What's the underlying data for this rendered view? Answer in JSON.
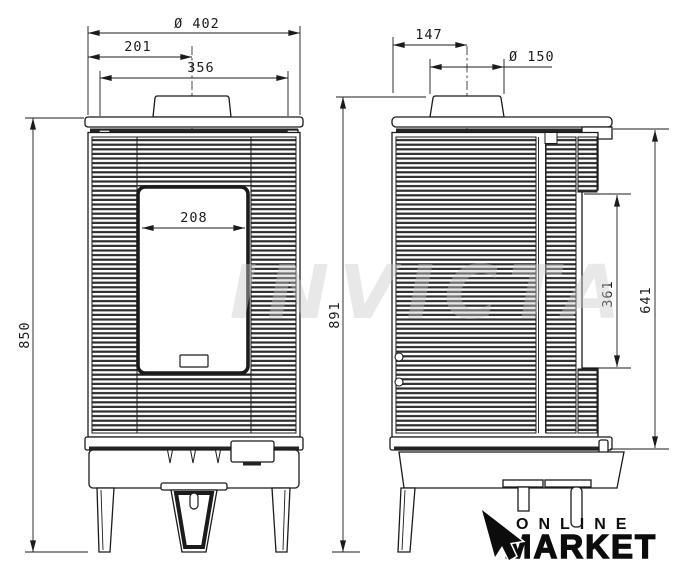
{
  "front_view": {
    "dims": {
      "total_width": "Ø 402",
      "flue_center_offset": "201",
      "top_plate_width": "356",
      "glass_width": "208",
      "body_height": "850"
    }
  },
  "side_view": {
    "dims": {
      "flue_center_offset": "147",
      "flue_diameter": "Ø 150",
      "total_height": "891",
      "side_panel_height": "361",
      "body_height": "641"
    }
  },
  "watermark": {
    "text": "INVICTA"
  },
  "logo": {
    "top": "ONLINE",
    "bottom": "MARKET",
    "icon": "cursor-arrow-icon"
  },
  "colors": {
    "line": "#1b1b1b",
    "rib": "#2e2e2e",
    "watermark": "#c9c9c9",
    "logo": "#0c0c0c",
    "background": "#ffffff"
  }
}
